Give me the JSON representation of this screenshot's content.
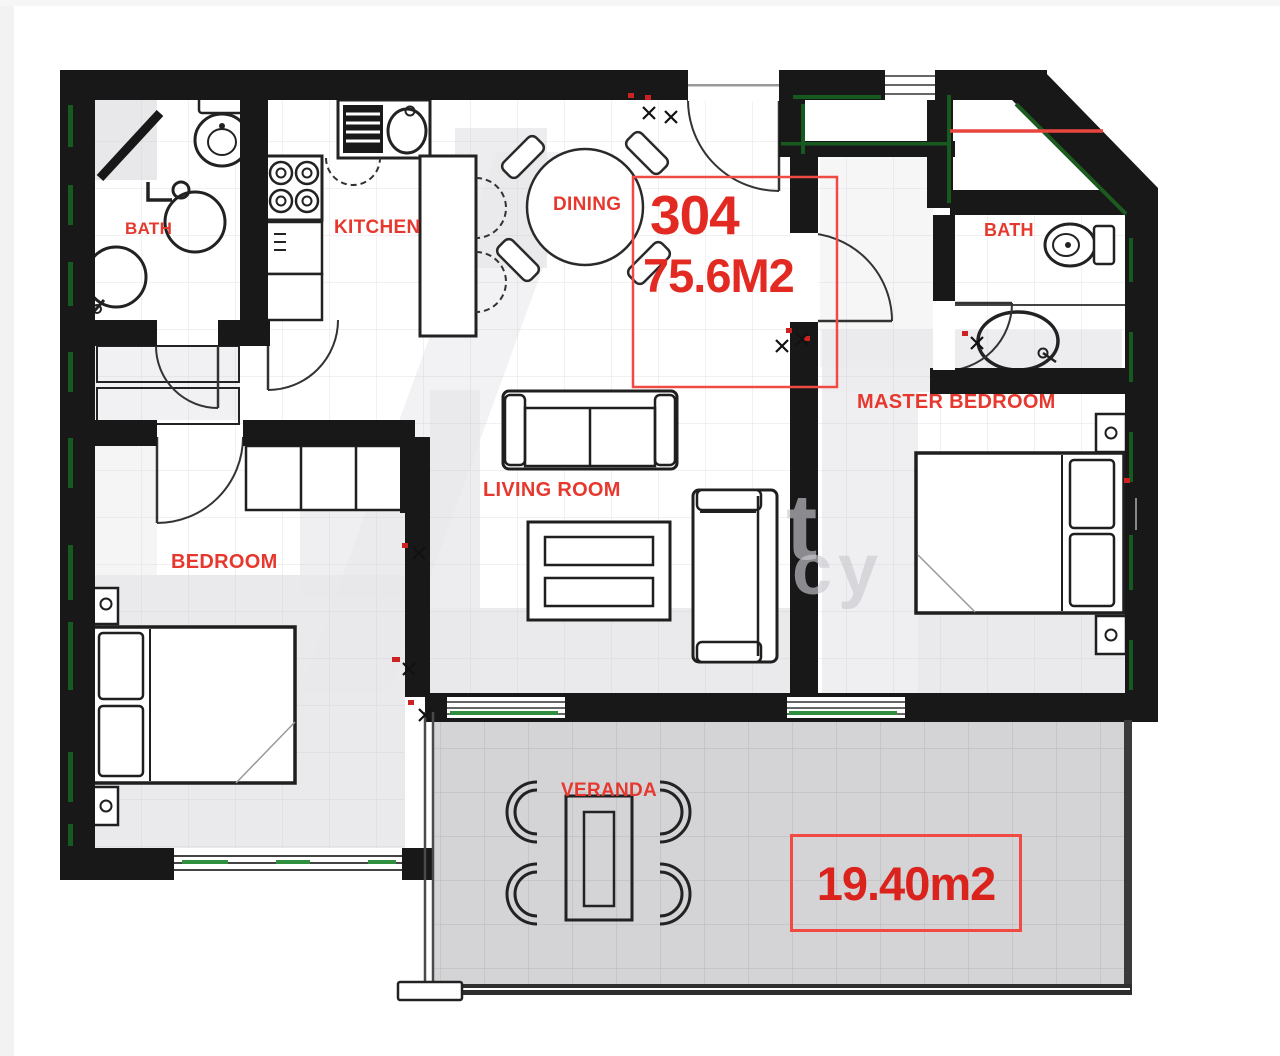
{
  "plan": {
    "unit": {
      "number": "304",
      "area": "75.6M2"
    },
    "veranda": {
      "area": "19.40m2"
    },
    "rooms": {
      "bath_left": "BATH",
      "kitchen": "KITCHEN",
      "dining": "DINING",
      "master_bedroom": "MASTER BEDROOM",
      "bath_right": "BATH",
      "living_room": "LIVING ROOM",
      "bedroom": "BEDROOM",
      "veranda": "VERANDA"
    }
  },
  "watermark": {
    "fragment_1": "t",
    "fragment_2": "cy"
  },
  "colors": {
    "label_red": "#e6382e",
    "annotation_red": "#f04a42",
    "wall_black": "#181818",
    "accent_green": "#175a1f",
    "floor_gray": "#e8e8eb",
    "veranda_gray": "#d4d4d6"
  }
}
